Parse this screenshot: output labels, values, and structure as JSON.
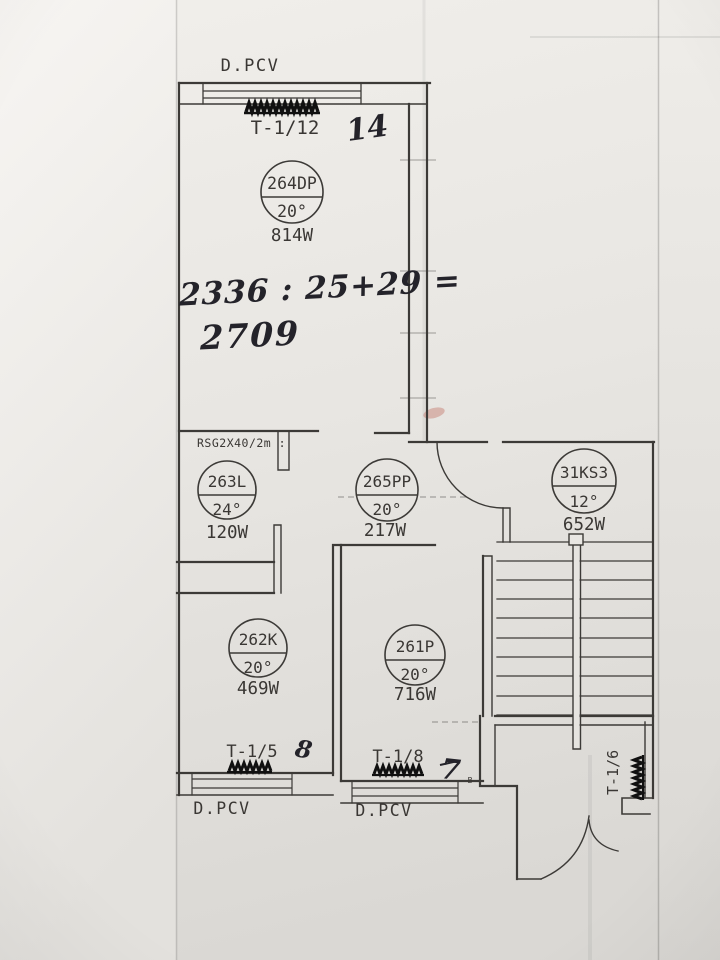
{
  "photo": {
    "window_top_label": "D.PCV",
    "window_bottom_left_label": "D.PCV",
    "window_bottom_mid_label": "D.PCV",
    "radiators": {
      "top": "T-1/12",
      "bottom_left": "T-1/5",
      "bottom_mid": "T-1/8",
      "entry": "T-1/6"
    },
    "cable_label": "RSG2X40/2m :",
    "corner_mark": "B",
    "handwriting": {
      "top_number": "14",
      "equation_line1": "2336 : 25+29 =",
      "equation_line2": "2709",
      "room_left_number": "8",
      "room_mid_number": "7"
    },
    "rooms": [
      {
        "id": "264DP",
        "temp": "20°",
        "power": "814W"
      },
      {
        "id": "263L",
        "temp": "24°",
        "power": "120W"
      },
      {
        "id": "265PP",
        "temp": "20°",
        "power": "217W"
      },
      {
        "id": "31KS3",
        "temp": "12°",
        "power": "652W"
      },
      {
        "id": "262K",
        "temp": "20°",
        "power": "469W"
      },
      {
        "id": "261P",
        "temp": "20°",
        "power": "716W"
      }
    ],
    "colors": {
      "ink": "#3c3a37",
      "paper": "#e9e7e3"
    }
  }
}
